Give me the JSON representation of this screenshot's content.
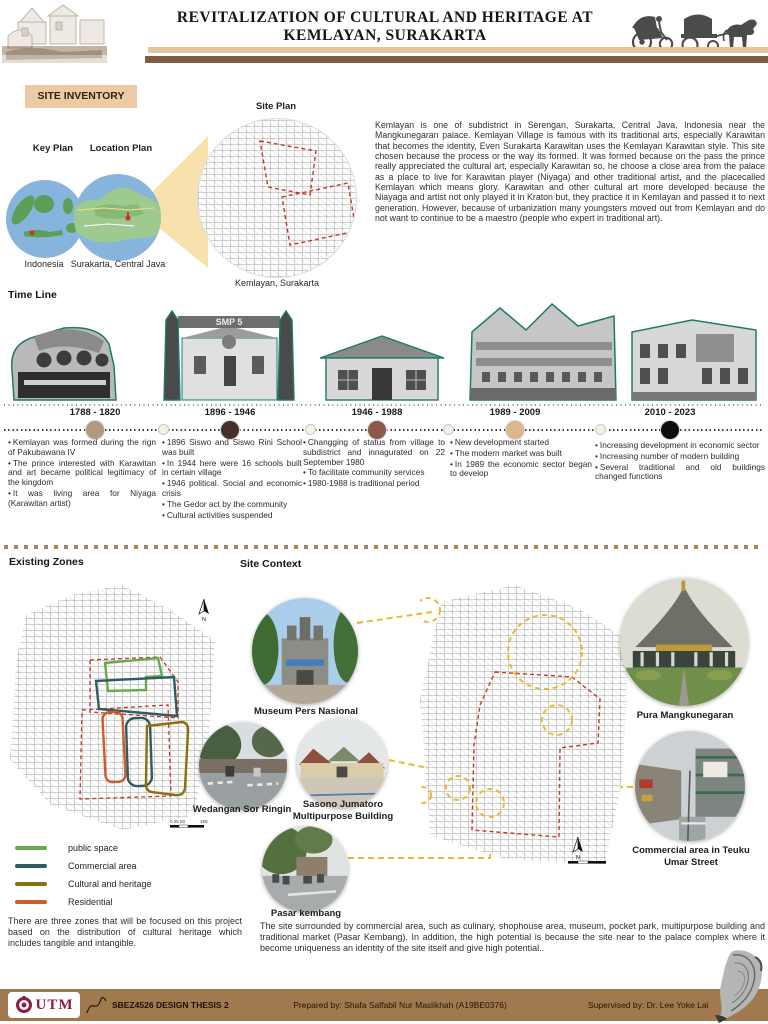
{
  "header": {
    "title_line1": "REVITALIZATION OF CULTURAL AND HERITAGE AT",
    "title_line2": "KEMLAYAN, SURAKARTA"
  },
  "site_inventory": {
    "badge": "SITE INVENTORY",
    "key_plan_label": "Key Plan",
    "location_plan_label": "Location Plan",
    "site_plan_label": "Site Plan",
    "indonesia_caption": "Indonesia",
    "surakarta_caption": "Surakarta, Central Java",
    "kemlayan_caption": "Kemlayan, Surakarta",
    "intro_paragraph": "Kemlayan is one of subdistrict in Serengan, Surakarta, Central Java, Indonesia near the Mangkunegaran palace. Kemlayan Village is famous with its traditional arts, especially Karawitan that becomes the identity, Even Surakarta Karawitan uses the Kemlayan Karawitan style. This site chosen because the process or the way its formed. It was formed because on the pass the prince really appreciated the cultural art, especially Karawitan so, he choose a close area from the palace as a place to live for Karawitan player (Niyaga) and other traditional artist, and the placecalled Kemlayan which means glory. Karawitan and other cultural art more developed because the Niayaga and artist not only played it in Kraton but, they practice it in Kemlayan and passed it to next generation. However, because of urbanization many youngsters moved out from Kemlayan and do not want to continue to be a maestro (people who expert in traditional art)."
  },
  "timeline": {
    "heading": "Time Line",
    "gate_sign": "SMP 5",
    "periods": [
      {
        "range": "1788 - 1820",
        "dot_color": "#b49a7d",
        "bullets": [
          "Kemlayan was formed during the rign of Pakubawana IV",
          "The prince interested with Karawitan and art became political legitimacy of the kingdom",
          "It was living area for Niyaga (Karawitan artist)"
        ]
      },
      {
        "range": "1896 - 1946",
        "dot_color": "#46312a",
        "bullets": [
          "1896 Siswo and Siswo Rini School was built",
          "In 1944 here were 16 schools built in certain village",
          "1946 political. Social and economic crisis",
          "The Gedor act by the community",
          "Cultural activities suspended"
        ]
      },
      {
        "range": "1946 - 1988",
        "dot_color": "#8e594a",
        "bullets": [
          "Changging of status from village to subdistrict and innagurated on 22 September 1980",
          "To facilitate community services",
          "1980-1988 is traditional period"
        ]
      },
      {
        "range": "1989 - 2009",
        "dot_color": "#dcb68c",
        "bullets": [
          "New development started",
          "The modern market was built",
          "In 1989 the economic sector began to develop"
        ]
      },
      {
        "range": "2010 - 2023",
        "dot_color": "#0d0d0d",
        "bullets": [
          "Increasing development in economic sector",
          "Increasing number of modern building",
          "Several traditional and old buildings changed functions"
        ]
      }
    ]
  },
  "zones": {
    "heading": "Existing Zones",
    "north_label": "N",
    "scale_text": "0 25 50",
    "scale_text_end": "150",
    "legend": [
      {
        "label": "public space",
        "color": "#6aa84f"
      },
      {
        "label": "Commercial area",
        "color": "#2d5d63"
      },
      {
        "label": "Cultural and heritage",
        "color": "#8a7010"
      },
      {
        "label": "Residential",
        "color": "#cf5b28"
      }
    ],
    "note": "There are three zones that will be focused on this project based on the distribution of cultural heritage which includes tangible and intangible."
  },
  "site_context": {
    "heading": "Site Context",
    "north_label": "N",
    "photos": [
      {
        "caption": "Museum Pers Nasional"
      },
      {
        "caption": "Wedangan Sor Ringin"
      },
      {
        "caption": "Sasono Jumatoro Multipurpose Building"
      },
      {
        "caption": "Pasar kembang"
      },
      {
        "caption": "Pura Mangkunegaran"
      },
      {
        "caption": "Commercial area in Teuku Umar Street"
      }
    ],
    "note": "The site surrounded by commercial area, such as culinary, shophouse area, museum, pocket park, multipurpose building and traditional market (Pasar Kembang). In addition, the high potential is because the site near to the palace complex where it become uniqueness an identity of the site itself and give high potential.."
  },
  "footer": {
    "logo_text": "UTM",
    "course": "SBEZ4526 DESIGN THESIS 2",
    "prepared_by": "Prepared by: Shafa Salfabil Nur Maslikhah (A19BE0376)",
    "supervised_by": "Supervised by:  Dr. Lee Yoke Lai"
  },
  "colors": {
    "header_bar_tan": "#e3c3a0",
    "header_bar_brown": "#7d5c42",
    "badge_bg": "#eccaa3",
    "footer_bar": "#a1794f",
    "photo_outline_teal": "#1e7a6e",
    "boundary_red_dashed": "#c0392b",
    "connector_yellow_dashed": "#e8bb2e"
  }
}
